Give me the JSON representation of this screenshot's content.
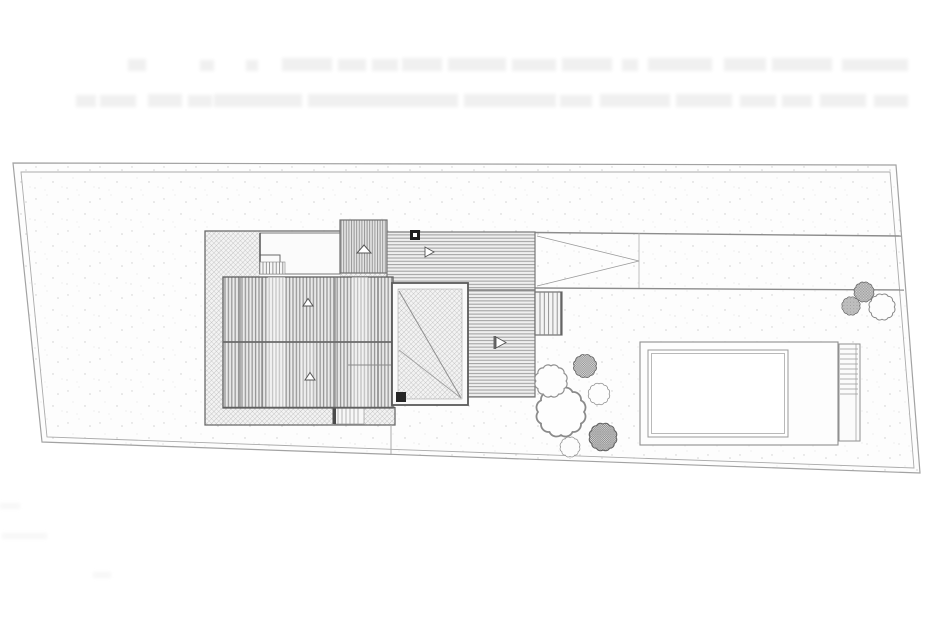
{
  "meta": {
    "description": "Scanned architectural site plan (roof / top view): house with terrace, pergola, wooden deck, driveway ramp, garden shrubs and swimming pool inside a skewed rectangular parcel",
    "legible_text": "none - only faint illegible scanner ghost text near the top edge"
  },
  "colors": {
    "paper": "#ffffff",
    "boundary_line": "#a2a2a2",
    "building_line": "#5f5f5f",
    "hatch_line": "#a9a9a9",
    "stripe_line": "#8f8f8f",
    "deck_bg": "#efefef",
    "roof_bg": "#d9d9d9",
    "tree_line": "#6e6e6e",
    "accent_black": "#1e1e1e"
  },
  "elements": {
    "parcel": "property boundary, double line, skewed rectangle",
    "main_roof": "dense vertical-plank roof with central ridge line and 2 slope arrows",
    "upper_roof_block": "small secondary roof volume with slope arrow",
    "terrace_platform": "diamond cross-hatched terrace wrapping the roof",
    "notch_room": "white recess in terrace with small stair",
    "pergola": "white-bordered lattice square with diagonal braces and black corner post",
    "deck": "horizontal-plank deck (L-shaped) with 2 direction arrows and chimney square",
    "driveway": "band from deck to right boundary with ramp triangle",
    "stairs": [
      "terrace stair (north recess)",
      "terrace stair (south edge)",
      "deck stair (east)"
    ],
    "pool": "rectangular pool, double-lined water basin, surround and rung steps at right",
    "tree_clusters": [
      "garden shrubs left of pool (6 bushes)",
      "shrubs at right boundary (3 bushes)"
    ]
  },
  "counts": {
    "pool_step_rungs": 10,
    "slope_arrows": 5,
    "black_squares": 2
  }
}
